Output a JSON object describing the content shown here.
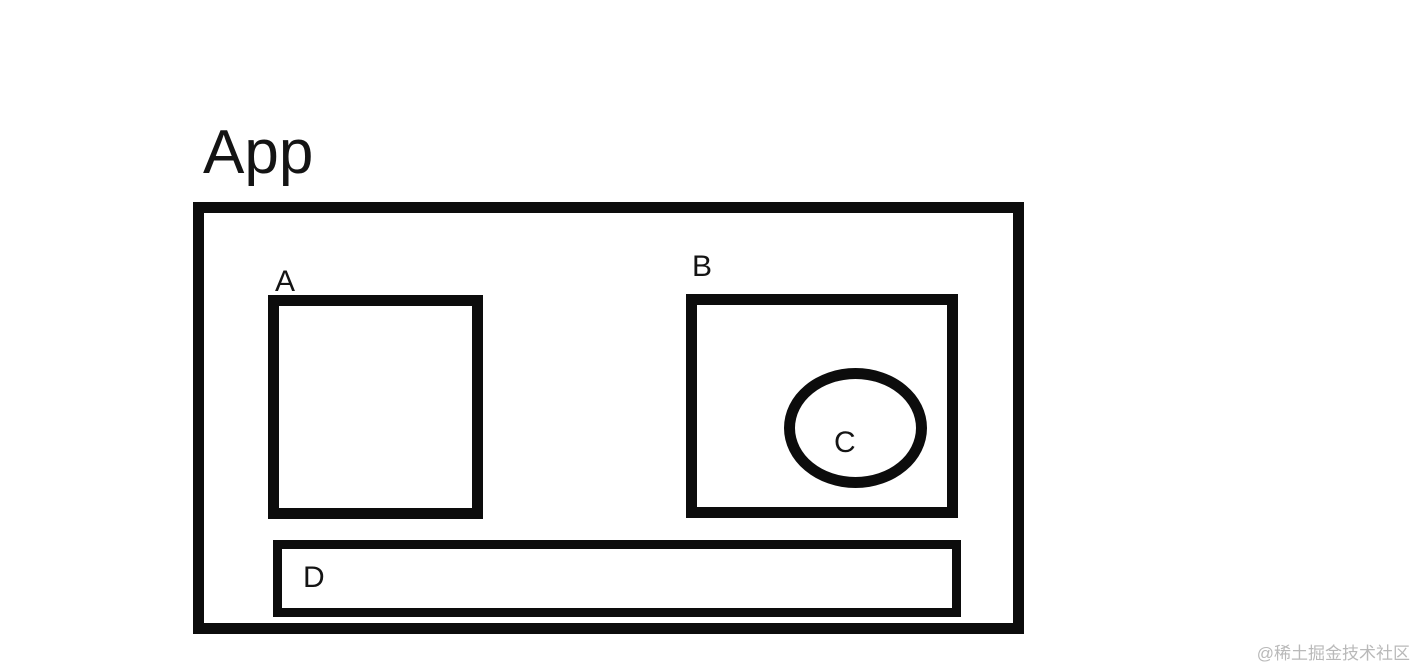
{
  "diagram": {
    "title": "App",
    "boxes": {
      "a": {
        "label": "A"
      },
      "b": {
        "label": "B"
      },
      "c": {
        "label": "C"
      },
      "d": {
        "label": "D"
      }
    }
  },
  "watermark": {
    "text": "@稀土掘金技术社区"
  },
  "colors": {
    "stroke": "#0c0c0c",
    "background": "#ffffff",
    "watermark": "#b9b9b9"
  }
}
